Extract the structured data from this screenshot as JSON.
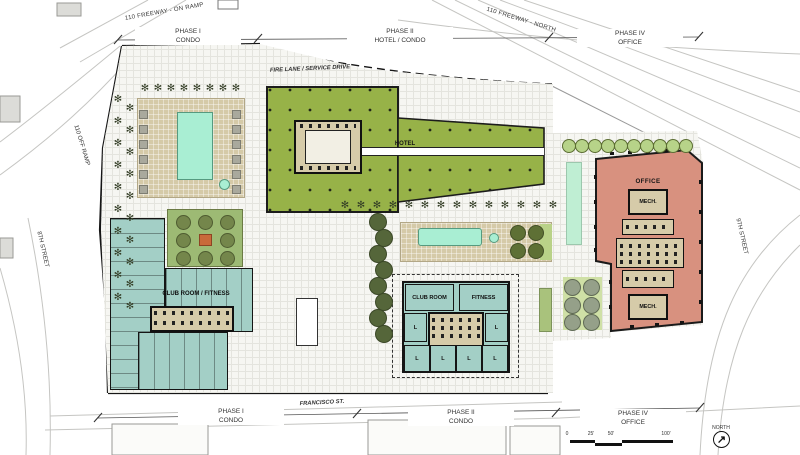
{
  "canvas": {
    "width": 800,
    "height": 455
  },
  "colors": {
    "hotel_roof_green": "#97b248",
    "condo_teal": "#a3cfc6",
    "office_salmon": "#d8917f",
    "deck_tan": "#d5caa8",
    "pool_aqua": "#a9eed3"
  },
  "phase_labels": {
    "top": [
      {
        "phase": "PHASE I",
        "use": "CONDO"
      },
      {
        "phase": "PHASE II",
        "use": "HOTEL / CONDO"
      },
      {
        "phase": "PHASE IV",
        "use": "OFFICE"
      }
    ],
    "bottom": [
      {
        "phase": "PHASE I",
        "use": "CONDO"
      },
      {
        "phase": "PHASE II",
        "use": "CONDO"
      },
      {
        "phase": "PHASE IV",
        "use": "OFFICE"
      }
    ]
  },
  "streets": {
    "freeway_on_ramp": "110 FREEWAY - ON RAMP",
    "freeway_north": "110 FREEWAY - NORTH",
    "off_ramp": "110 OFF RAMP",
    "eighth_street": "8TH STREET",
    "ninth_street": "9TH STREET",
    "francisco": "FRANCISCO ST.",
    "fire_lane": "FIRE LANE / SERVICE DRIVE"
  },
  "buildings": {
    "hotel": "HOTEL",
    "office": "OFFICE",
    "mech": "MECH.",
    "club_room_fitness": "CLUB ROOM / FITNESS",
    "club_room": "CLUB ROOM",
    "fitness": "FITNESS",
    "unit_label": "L"
  },
  "scale_bar": {
    "ticks": [
      "0",
      "25'",
      "50'",
      "100'"
    ]
  },
  "north": {
    "label": "NORTH",
    "arrow": "↗"
  },
  "icons": {
    "palm_tree": "✻"
  }
}
